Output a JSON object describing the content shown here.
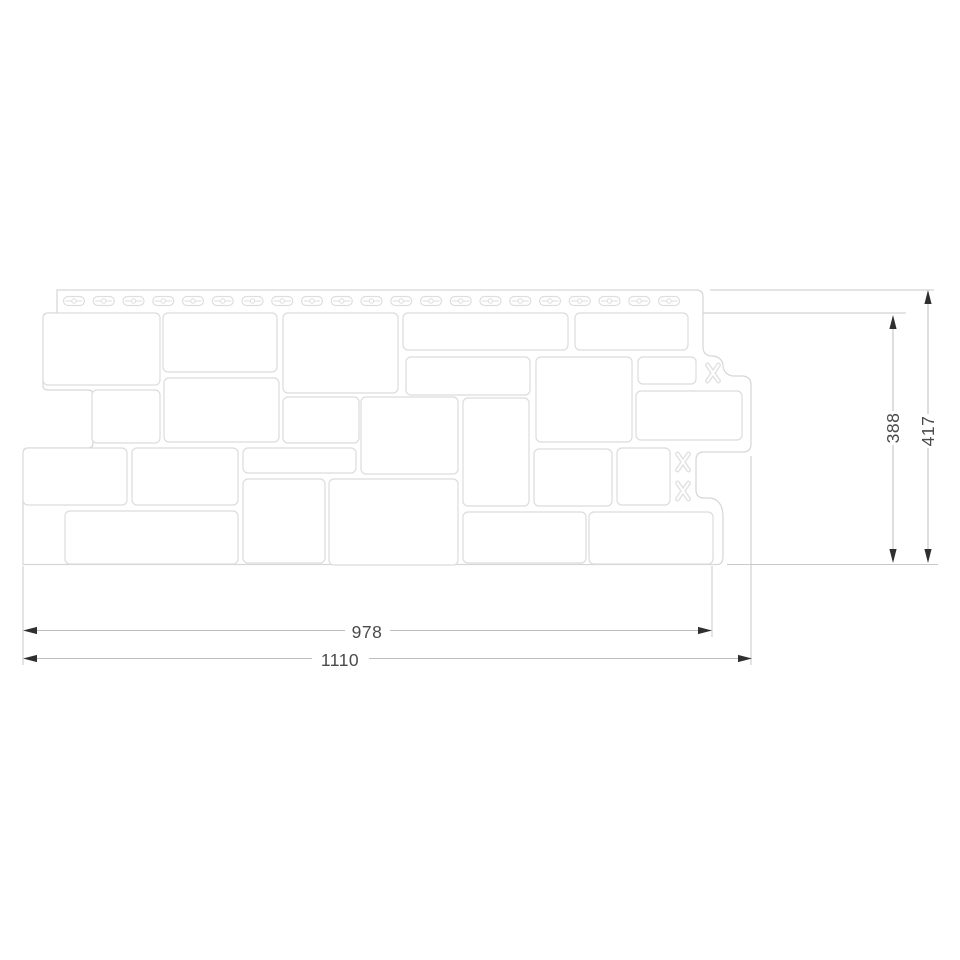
{
  "page": {
    "background": "#ffffff",
    "title": "Facade panel technical drawing"
  },
  "drawing": {
    "type": "technical-drawing",
    "subject": "stone-pattern-facade-panel-with-nail-hem",
    "colors": {
      "background": "#ffffff",
      "outline": "#d6d6d6",
      "stone_stroke": "#dcdcdc",
      "stone_fill": "#ffffff",
      "extension_line": "#c9c9c9",
      "dim_line": "#bdbdbd",
      "arrow": "#2f2f2f",
      "text": "#4a4a4a"
    },
    "panel": {
      "outline_path": "M 57 290 H 696 Q 703 290 703 297 V 347 Q 703 355 711 356 L 713 356 Q 721 357 723 364 L 723 367 Q 725 375 733 376 H 743 Q 751 377 751 385 V 444 Q 751 452 743 452 H 704 Q 696 452 696 460 V 490 Q 696 498 704 498 H 710 Q 718 499 721 506 Q 723 510 723 516 V 556 Q 723 564 718 564.5 L 23 564.5 V 453 Q 23 448 28 448 H 88 Q 93 448 93 443 V 395 Q 93 390 88 390 H 48 Q 43 390 43 385 V 318 Q 43 313 48 313 H 57 Z",
      "strip_bottom_line": [
        57,
        313,
        700,
        313
      ],
      "slots": {
        "count": 21,
        "first_cx": 74,
        "spacing": 29.75,
        "cy": 301,
        "width": 21,
        "height": 9
      },
      "stones": [
        [
          43,
          313,
          117,
          72
        ],
        [
          163,
          313,
          114,
          59
        ],
        [
          283,
          313,
          115,
          80
        ],
        [
          403,
          313,
          165,
          37
        ],
        [
          575,
          313,
          113,
          37
        ],
        [
          92,
          390,
          68,
          53
        ],
        [
          164,
          378,
          115,
          64
        ],
        [
          406,
          357,
          124,
          38
        ],
        [
          536,
          357,
          96,
          85
        ],
        [
          638,
          357,
          58,
          27
        ],
        [
          283,
          397,
          76,
          46
        ],
        [
          361,
          397,
          97,
          77
        ],
        [
          463,
          398,
          66,
          108
        ],
        [
          636,
          391,
          106,
          49
        ],
        [
          23,
          448,
          104,
          57
        ],
        [
          132,
          448,
          106,
          57
        ],
        [
          243,
          448,
          113,
          25
        ],
        [
          534,
          449,
          78,
          57
        ],
        [
          617,
          448,
          53,
          57
        ],
        [
          243,
          479,
          82,
          84
        ],
        [
          329,
          479,
          129,
          86
        ],
        [
          65,
          511,
          173,
          53
        ],
        [
          463,
          512,
          123,
          51
        ],
        [
          589,
          512,
          124,
          52
        ]
      ],
      "lock_tabs": [
        [
          713,
          373
        ],
        [
          683,
          462
        ],
        [
          683,
          491
        ]
      ]
    },
    "extension_lines": [
      [
        700,
        313,
        906,
        313
      ],
      [
        710,
        290,
        934,
        290
      ],
      [
        727,
        564.5,
        938,
        564.5
      ],
      [
        23,
        566,
        23,
        665
      ],
      [
        712,
        566,
        712,
        637
      ],
      [
        751,
        456,
        751,
        665
      ]
    ],
    "dimensions": [
      {
        "id": "width-978",
        "label": "978",
        "orientation": "horizontal",
        "segments": [
          [
            25,
            630.5,
            345,
            630.5
          ],
          [
            390,
            630.5,
            711,
            630.5
          ]
        ],
        "arrows": [
          [
            "left",
            23,
            630.5
          ],
          [
            "right",
            712,
            630.5
          ]
        ]
      },
      {
        "id": "width-1110",
        "label": "1110",
        "orientation": "horizontal",
        "segments": [
          [
            25,
            658.5,
            312,
            658.5
          ],
          [
            369,
            658.5,
            751,
            658.5
          ]
        ],
        "arrows": [
          [
            "left",
            23,
            658.5
          ],
          [
            "right",
            752,
            658.5
          ]
        ]
      },
      {
        "id": "height-388",
        "label": "388",
        "orientation": "vertical",
        "segments": [
          [
            893,
            317,
            893,
            411
          ],
          [
            893,
            445,
            893,
            562
          ]
        ],
        "arrows": [
          [
            "up",
            893,
            315
          ],
          [
            "down",
            893,
            563
          ]
        ]
      },
      {
        "id": "height-417",
        "label": "417",
        "orientation": "vertical",
        "segments": [
          [
            928,
            292,
            928,
            414
          ],
          [
            928,
            448,
            928,
            562
          ]
        ],
        "arrows": [
          [
            "up",
            928,
            290
          ],
          [
            "down",
            928,
            563
          ]
        ]
      }
    ]
  }
}
